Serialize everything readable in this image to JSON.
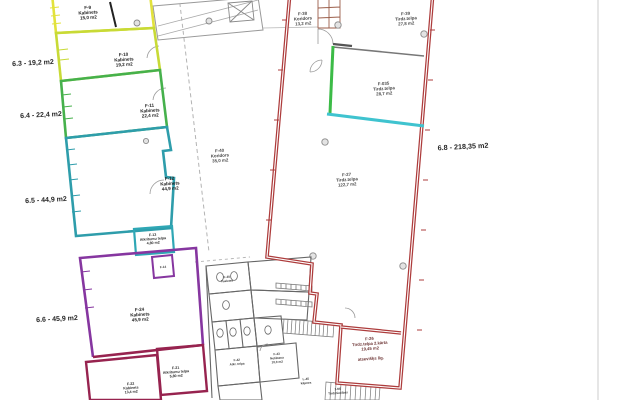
{
  "document": {
    "type": "architectural-floor-plan"
  },
  "dims": {
    "d63": "6.3 - 19,2 m2",
    "d64": "6.4 - 22,4 m2",
    "d65": "6.5 - 44,9 m2",
    "d66": "6.6 - 45,9 m2",
    "d68": "6.8 - 218,35 m2"
  },
  "rooms": {
    "f9": [
      "F-9",
      "Kabinets",
      "15,0 m2"
    ],
    "f10": [
      "F-10",
      "Kabinets",
      "19,2 m2"
    ],
    "f11": [
      "F-11",
      "Kabinets",
      "22,4 m2"
    ],
    "f12": [
      "F-12",
      "Kabinets",
      "44,9 m2"
    ],
    "f13": [
      "F-13",
      "Atkritumu telpa",
      "4,80 m2"
    ],
    "f14": [
      "F-14"
    ],
    "f24": [
      "F-24",
      "Kabinets",
      "45,9 m2"
    ],
    "f22": [
      "F-22",
      "Kabinets",
      "13,4 m2"
    ],
    "f21": [
      "F-21",
      "Atkritumu telpa",
      "5,80 m2"
    ],
    "f40": [
      "F-40",
      "Koridors",
      "35,0 m2"
    ],
    "f38": [
      "F-38",
      "Koridors",
      "13,2 m2"
    ],
    "f39": [
      "F-39",
      "Tirdz.telpa",
      "27,8 m2"
    ],
    "f035": [
      "F-035",
      "Tirdz.telpa",
      "28,7 m2"
    ],
    "f27": [
      "F-27",
      "Tirdz.telpa",
      "122,7 m2"
    ],
    "f26": [
      "F-26",
      "Tirdz.telpa 2.kārta",
      "19,45 m2"
    ],
    "f26_note": "atsevišķs līg.",
    "f30": [
      "F-30",
      "Tualetes"
    ],
    "f42": [
      "F-42",
      "Atkr. telpa"
    ],
    "f43": [
      "F-43",
      "Noliktava",
      "10,0 m2"
    ],
    "l45": [
      "L-45",
      "kāpnes"
    ],
    "n5": [
      "1-N5",
      "Tirdzniecības"
    ]
  },
  "colors": {
    "room_f9": "#e2e23c",
    "room_f10": "#c8da36",
    "room_f11": "#46b14c",
    "room_f12": "#2e9dab",
    "room_f13": "#2fa7b5",
    "accent_green": "#3cbb47",
    "accent_cyan": "#3fc3cf",
    "room_f24": "#8636a0",
    "room_bottom": "#97234f",
    "hall_red": "#ad3c3c"
  }
}
